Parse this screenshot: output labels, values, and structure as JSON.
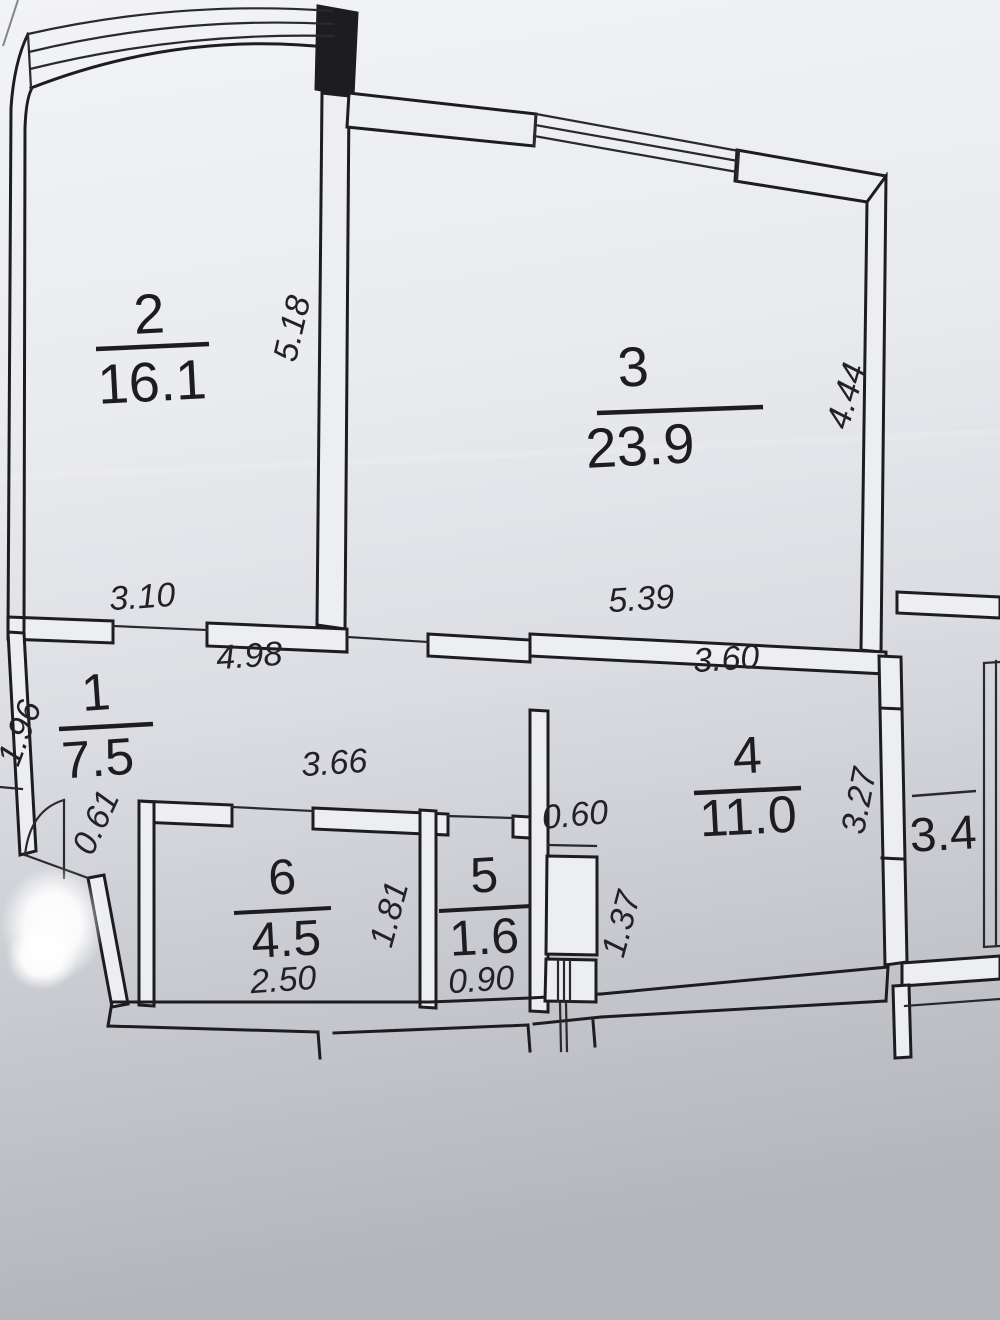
{
  "document": {
    "kind": "apartment floor plan (scanned photo)",
    "colors": {
      "ink": "#1d1d1f",
      "paper_light": "#f2f3f6",
      "paper_dark": "#b3b5bb"
    }
  },
  "rooms": {
    "r1": {
      "number": "1",
      "area": "7.5"
    },
    "r2": {
      "number": "2",
      "area": "16.1"
    },
    "r3": {
      "number": "3",
      "area": "23.9"
    },
    "r4": {
      "number": "4",
      "area": "11.0"
    },
    "r5": {
      "number": "5",
      "area": "1.6"
    },
    "r6": {
      "number": "6",
      "area": "4.5"
    },
    "balcony": {
      "area": "3.4"
    }
  },
  "dims": {
    "d518": "5.18",
    "d310": "3.10",
    "d444": "4.44",
    "d539": "5.39",
    "d498": "4.98",
    "d366": "3.66",
    "d360": "3.60",
    "d196": "1.96",
    "d061": "0.61",
    "d060": "0.60",
    "d137": "1.37",
    "d327": "3.27",
    "d181": "1.81",
    "d250": "2.50",
    "d090": "0.90"
  }
}
